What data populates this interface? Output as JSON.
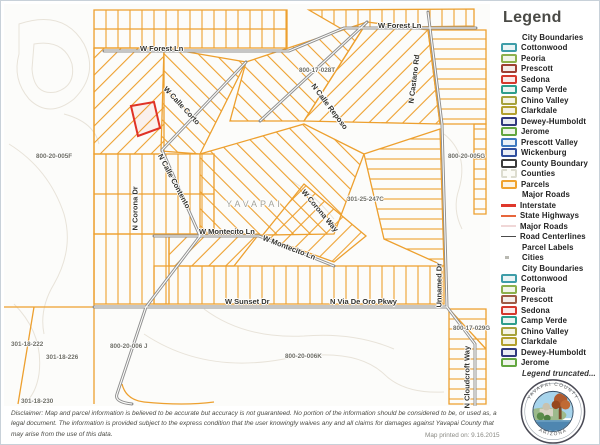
{
  "map": {
    "labels": [
      {
        "id": "forest1",
        "text": "W Forest Ln"
      },
      {
        "id": "forest2",
        "text": "W Forest Ln"
      },
      {
        "id": "p028t",
        "text": "800-17-028T"
      },
      {
        "id": "castano",
        "text": "N Castano Rd"
      },
      {
        "id": "reposo",
        "text": "N Calle Reposo"
      },
      {
        "id": "corto",
        "text": "W Calle Corto"
      },
      {
        "id": "p005f",
        "text": "800-20-005F"
      },
      {
        "id": "p005g",
        "text": "800-20-005G"
      },
      {
        "id": "coronadr",
        "text": "N Corona Dr"
      },
      {
        "id": "contento",
        "text": "N Calle Contento"
      },
      {
        "id": "yavapai",
        "text": "YAVAPAI"
      },
      {
        "id": "p247c",
        "text": "301-25-247C"
      },
      {
        "id": "coronaway",
        "text": "W Corona Way"
      },
      {
        "id": "mont1",
        "text": "W Montecito Ln"
      },
      {
        "id": "mont2",
        "text": "W Montecito Ln"
      },
      {
        "id": "sunset",
        "text": "W Sunset Dr"
      },
      {
        "id": "viadeoro",
        "text": "N Via De Oro Pkwy"
      },
      {
        "id": "unnamed",
        "text": "Unnamed Dr"
      },
      {
        "id": "p029g",
        "text": "800-17-029G"
      },
      {
        "id": "cloudcroft",
        "text": "N Cloudcroft Way"
      },
      {
        "id": "p006j",
        "text": "800-20-006 J"
      },
      {
        "id": "p006k",
        "text": "800-20-006K"
      },
      {
        "id": "p222",
        "text": "301-18-222"
      },
      {
        "id": "p226",
        "text": "301-18-226"
      },
      {
        "id": "p230",
        "text": "301-18-230"
      }
    ],
    "colors": {
      "parcel": "#EDA02F",
      "selected_parcel": "#E03226",
      "road": "#8F8F8F"
    }
  },
  "legend": {
    "title": "Legend",
    "items": [
      {
        "kind": "heading",
        "label": "City Boundaries"
      },
      {
        "kind": "box",
        "label": "Cottonwood",
        "color": "#3E9DA8",
        "fill": "#EAF4F5"
      },
      {
        "kind": "box",
        "label": "Peoria",
        "color": "#8CB04C",
        "fill": "#F2F6E9"
      },
      {
        "kind": "box",
        "label": "Prescott",
        "color": "#9E3F33",
        "fill": "#F5ECEA"
      },
      {
        "kind": "box",
        "label": "Sedona",
        "color": "#D5392D",
        "fill": "#FBEBEA"
      },
      {
        "kind": "box",
        "label": "Camp Verde",
        "color": "#2E9E8C",
        "fill": "#E9F5F2"
      },
      {
        "kind": "box",
        "label": "Chino Valley",
        "color": "#A6A23C",
        "fill": "#F5F4E6"
      },
      {
        "kind": "box",
        "label": "Clarkdale",
        "color": "#B3A02E",
        "fill": "#F5F2E3"
      },
      {
        "kind": "box",
        "label": "Dewey-Humboldt",
        "color": "#31397E",
        "fill": "#EAECF4"
      },
      {
        "kind": "box",
        "label": "Jerome",
        "color": "#62A63F",
        "fill": "#EFF5EA"
      },
      {
        "kind": "box",
        "label": "Prescott Valley",
        "color": "#3E79C0",
        "fill": "#EAF1F8"
      },
      {
        "kind": "box",
        "label": "Wickenburg",
        "color": "#2F4E9E",
        "fill": "#EAEEF6"
      },
      {
        "kind": "box",
        "label": "County Boundary",
        "color": "#3C3C3C",
        "fill": "#FFFFFF"
      },
      {
        "kind": "box",
        "label": "Counties",
        "color": "#DCDCCF",
        "fill": "#FBFBF6"
      },
      {
        "kind": "box",
        "label": "Parcels",
        "color": "#F0A32F",
        "fill": "#FCF4E4"
      },
      {
        "kind": "heading",
        "label": "Major Roads"
      },
      {
        "kind": "line",
        "label": "Interstate",
        "color": "#DF382C",
        "weight": 3
      },
      {
        "kind": "line",
        "label": "State Highways",
        "color": "#E7663C",
        "weight": 2.5
      },
      {
        "kind": "line",
        "label": "Major Roads",
        "color": "#F0D7D7",
        "weight": 2.5
      },
      {
        "kind": "line",
        "label": "Road Centerlines",
        "color": "#4A4A4A",
        "weight": 1.5
      },
      {
        "kind": "heading",
        "label": "Parcel Labels"
      },
      {
        "kind": "dot",
        "label": "Cities",
        "color": "#B9B9B2"
      },
      {
        "kind": "heading",
        "label": "City Boundaries"
      },
      {
        "kind": "box",
        "label": "Cottonwood",
        "color": "#3E9DA8",
        "fill": "#EAF4F5"
      },
      {
        "kind": "box",
        "label": "Peoria",
        "color": "#8CB04C",
        "fill": "#F2F6E9"
      },
      {
        "kind": "box",
        "label": "Prescott",
        "color": "#9E5B45",
        "fill": "#F5EEEA"
      },
      {
        "kind": "box",
        "label": "Sedona",
        "color": "#D5392D",
        "fill": "#FBEBEA"
      },
      {
        "kind": "box",
        "label": "Camp Verde",
        "color": "#2E9E8C",
        "fill": "#E9F5F2"
      },
      {
        "kind": "box",
        "label": "Chino Valley",
        "color": "#A6A23C",
        "fill": "#F5F4E6"
      },
      {
        "kind": "box",
        "label": "Clarkdale",
        "color": "#B3A02E",
        "fill": "#F5F2E3"
      },
      {
        "kind": "box",
        "label": "Dewey-Humboldt",
        "color": "#31397E",
        "fill": "#EAECF4"
      },
      {
        "kind": "box",
        "label": "Jerome",
        "color": "#62A63F",
        "fill": "#EFF5EA"
      },
      {
        "kind": "note",
        "label": "Legend truncated..."
      }
    ]
  },
  "footer": {
    "disclaimer": "Disclaimer: Map and parcel information is believed to be accurate but accuracy is not guaranteed. No portion of the information should be considered to be, or used as, a legal document.  The information is provided subject to the express condition that the user knowingly waives any and all claims for damages against Yavapai County that may arise from the use of this data.",
    "printed": "Map printed on: 9.16.2015"
  },
  "seal": {
    "top_text": "YAVAPAI COUNTY",
    "bottom_text": "ARIZONA"
  }
}
